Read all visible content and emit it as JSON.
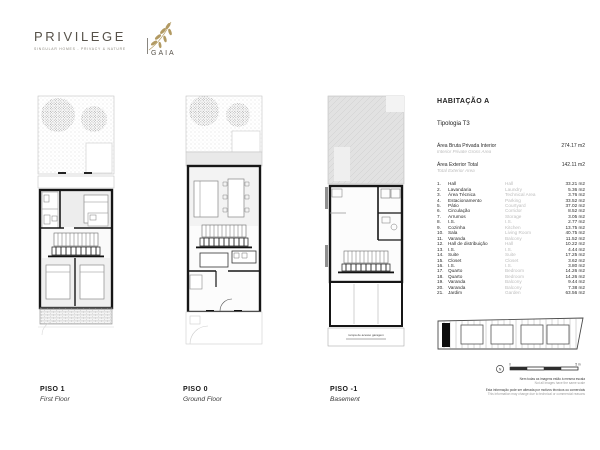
{
  "brand": {
    "name": "PRIVILEGE",
    "tagline": "SINGULAR HOMES - PRIVACY & NATURE",
    "sub_brand": "GAIA",
    "brand_color": "#57524a",
    "accent_color": "#b29a62"
  },
  "unit": {
    "title": "HABITAÇÃO A",
    "typology": "Tipologia T3"
  },
  "area_summary": [
    {
      "label_pt": "Área Bruta Privada Interior",
      "label_en": "Interior Private Gross Area",
      "value": "274.17 m2"
    },
    {
      "label_pt": "Área Exterior Total",
      "label_en": "Total Exterior Area",
      "value": "142.11 m2"
    }
  ],
  "area_table": {
    "rows": [
      {
        "num": "1.",
        "pt": "Hall",
        "en": "Hall",
        "value": "33.21 m2"
      },
      {
        "num": "2.",
        "pt": "Lavandaria",
        "en": "Laundry",
        "value": "5.36 m2"
      },
      {
        "num": "3.",
        "pt": "Área Técnica",
        "en": "Technical Area",
        "value": "3.76 m2"
      },
      {
        "num": "4.",
        "pt": "Estacionamento",
        "en": "Parking",
        "value": "33.52 m2"
      },
      {
        "num": "5.",
        "pt": "Pátio",
        "en": "Courtyard",
        "value": "37.02 m2"
      },
      {
        "num": "6.",
        "pt": "Circulação",
        "en": "Corridor",
        "value": "8.52 m2"
      },
      {
        "num": "7.",
        "pt": "Arrumos",
        "en": "Storage",
        "value": "3.05 m2"
      },
      {
        "num": "8.",
        "pt": "I.S.",
        "en": "I.S.",
        "value": "2.77 m2"
      },
      {
        "num": "9.",
        "pt": "Cozinha",
        "en": "Kitchen",
        "value": "13.75 m2"
      },
      {
        "num": "10.",
        "pt": "Sala",
        "en": "Living Room",
        "value": "40.75 m2"
      },
      {
        "num": "11.",
        "pt": "Varanda",
        "en": "Balcony",
        "value": "11.52 m2"
      },
      {
        "num": "12.",
        "pt": "Hall de distribuição",
        "en": "Hall",
        "value": "10.22 m2"
      },
      {
        "num": "13.",
        "pt": "I.S.",
        "en": "I.S.",
        "value": "4.44 m2"
      },
      {
        "num": "14.",
        "pt": "Suite",
        "en": "Suite",
        "value": "17.25 m2"
      },
      {
        "num": "15.",
        "pt": "Closet",
        "en": "Closet",
        "value": "3.62 m2"
      },
      {
        "num": "16.",
        "pt": "I.S.",
        "en": "I.S.",
        "value": "3.80 m2"
      },
      {
        "num": "17.",
        "pt": "Quarto",
        "en": "Bedroom",
        "value": "14.26 m2"
      },
      {
        "num": "18.",
        "pt": "Quarto",
        "en": "Bedroom",
        "value": "14.26 m2"
      },
      {
        "num": "19.",
        "pt": "Varanda",
        "en": "Balcony",
        "value": "9.44 m2"
      },
      {
        "num": "20.",
        "pt": "Varanda",
        "en": "Balcony",
        "value": "7.38 m2"
      },
      {
        "num": "21.",
        "pt": "Jardim",
        "en": "Garden",
        "value": "63.56 m2"
      }
    ]
  },
  "floors": [
    {
      "code": "PISO 1",
      "name_en": "First Floor"
    },
    {
      "code": "PISO 0",
      "name_en": "Ground Floor"
    },
    {
      "code": "PISO -1",
      "name_en": "Basement"
    }
  ],
  "plans": {
    "basement_ramp_label": "rampa de acesso garagem"
  },
  "site_key": {
    "north_label": "N",
    "scale_start": "0",
    "scale_end": "5 m"
  },
  "disclaimers": [
    {
      "pt": "Nem todas as imagens estão à mesma escala",
      "en": "Not all images have the same scale"
    },
    {
      "pt": "Esta informação pode ser alterada por motivos técnicos ou comerciais",
      "en": "This information may change due to technical or commercial reasons"
    }
  ]
}
